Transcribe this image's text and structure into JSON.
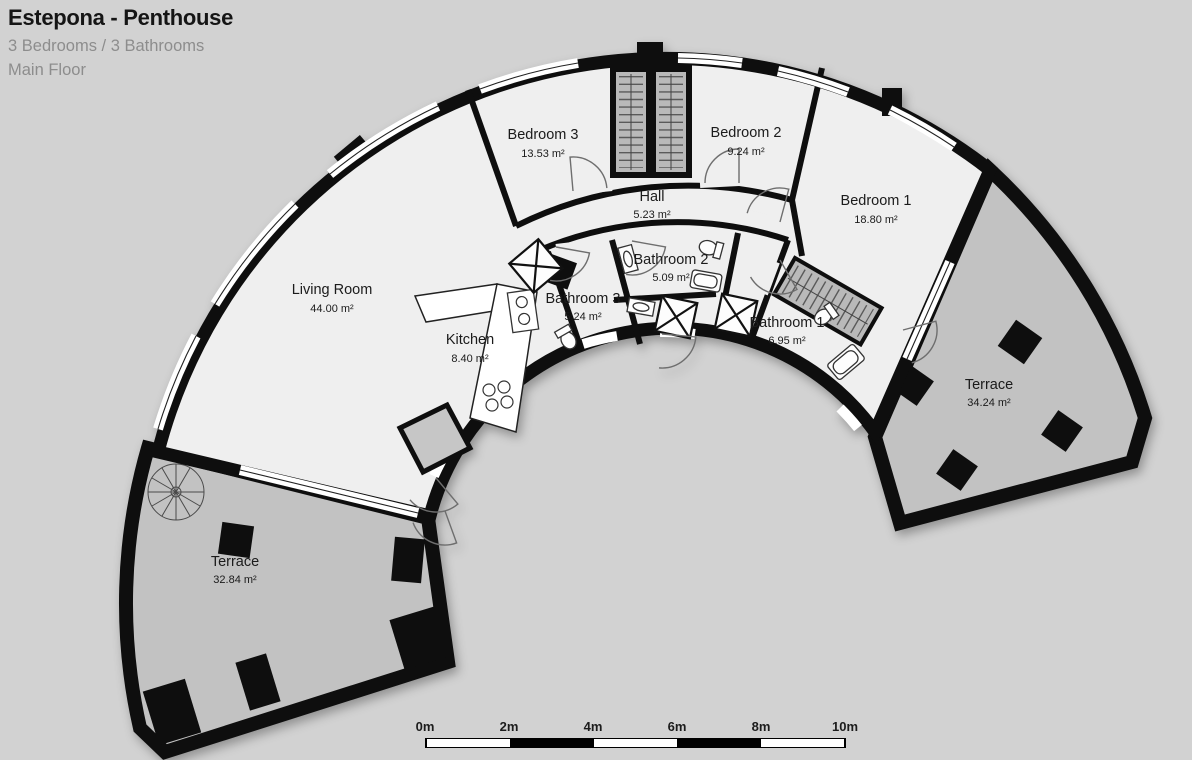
{
  "header": {
    "title": "Estepona - Penthouse",
    "subtitle": "3 Bedrooms / 3 Bathrooms",
    "floor": "Main Floor"
  },
  "rooms": {
    "bedroom3": {
      "name": "Bedroom 3",
      "area": "13.53 m²"
    },
    "bedroom2": {
      "name": "Bedroom 2",
      "area": "9.24 m²"
    },
    "bedroom1": {
      "name": "Bedroom 1",
      "area": "18.80 m²"
    },
    "hall": {
      "name": "Hall",
      "area": "5.23 m²"
    },
    "bathroom2": {
      "name": "Bathroom 2",
      "area": "5.09 m²"
    },
    "bathroom3": {
      "name": "Bathroom 3",
      "area": "5.24 m²"
    },
    "bathroom1": {
      "name": "Bathroom 1",
      "area": "6.95 m²"
    },
    "living_room": {
      "name": "Living Room",
      "area": "44.00 m²"
    },
    "kitchen": {
      "name": "Kitchen",
      "area": "8.40 m²"
    },
    "terrace_right": {
      "name": "Terrace",
      "area": "34.24 m²"
    },
    "terrace_left": {
      "name": "Terrace",
      "area": "32.84 m²"
    }
  },
  "scale_bar": {
    "ticks": [
      "0m",
      "2m",
      "4m",
      "6m",
      "8m",
      "10m"
    ]
  },
  "colors": {
    "background": "#d2d2d2",
    "floor": "#efefef",
    "terrace": "#c2c2c2",
    "wall": "#0e0e0e",
    "wardrobe": "#b9b9b9",
    "title_text": "#151515",
    "muted_text": "#8d8d8d"
  }
}
